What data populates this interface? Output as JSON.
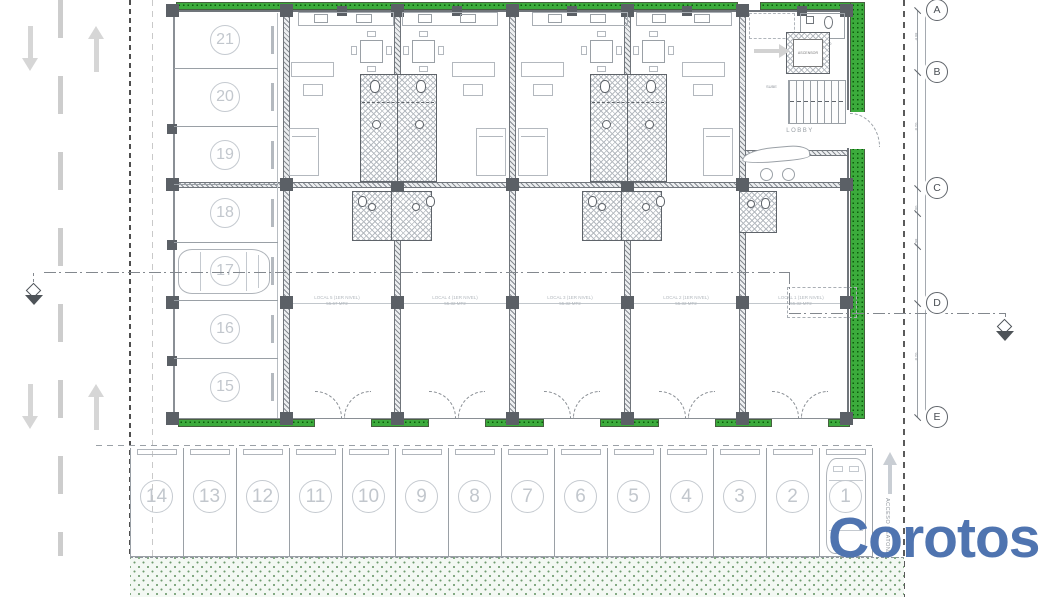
{
  "title": "First level floor plan",
  "watermark": {
    "text": "Corotos",
    "color": "#4f74b0"
  },
  "plan": {
    "grid_letters": [
      "A",
      "B",
      "C",
      "D",
      "E"
    ],
    "dim_labels": [
      "4.08",
      "8.20",
      "1.00",
      "4.98",
      "8.20"
    ],
    "locals": [
      {
        "name": "LOCAL 5 (1ER NIVEL)",
        "area": "55.67 MT2"
      },
      {
        "name": "LOCAL 4 (1ER NIVEL)",
        "area": "55.32 MT2"
      },
      {
        "name": "LOCAL 3 (1ER NIVEL)",
        "area": "55.32 MT2"
      },
      {
        "name": "LOCAL 2 (1ER NIVEL)",
        "area": "55.32 MT2"
      },
      {
        "name": "LOCAL 1 (1ER NIVEL)",
        "area": "55.32 MT2"
      }
    ],
    "labels": {
      "lobby": "LOBBY",
      "elevator": "ASCENSOR",
      "half_bath": "1/2 BAÑO",
      "stairs_up": "SUBE",
      "pedestrian_access": "ACCESO PEATONAL"
    },
    "parking_left": [
      "21",
      "20",
      "19",
      "18",
      "17",
      "16",
      "15"
    ],
    "parking_bottom": [
      "14",
      "13",
      "12",
      "11",
      "10",
      "9",
      "8",
      "7",
      "6",
      "5",
      "4",
      "3",
      "2",
      "1"
    ]
  },
  "colors": {
    "green_strip": "#3cab3c",
    "green_dark": "#0b5e0b",
    "wall_gray": "#5f646a",
    "line_gray": "#9aa0a6",
    "light_gray": "#c5cad0",
    "watermark_blue": "#4f74b0"
  }
}
